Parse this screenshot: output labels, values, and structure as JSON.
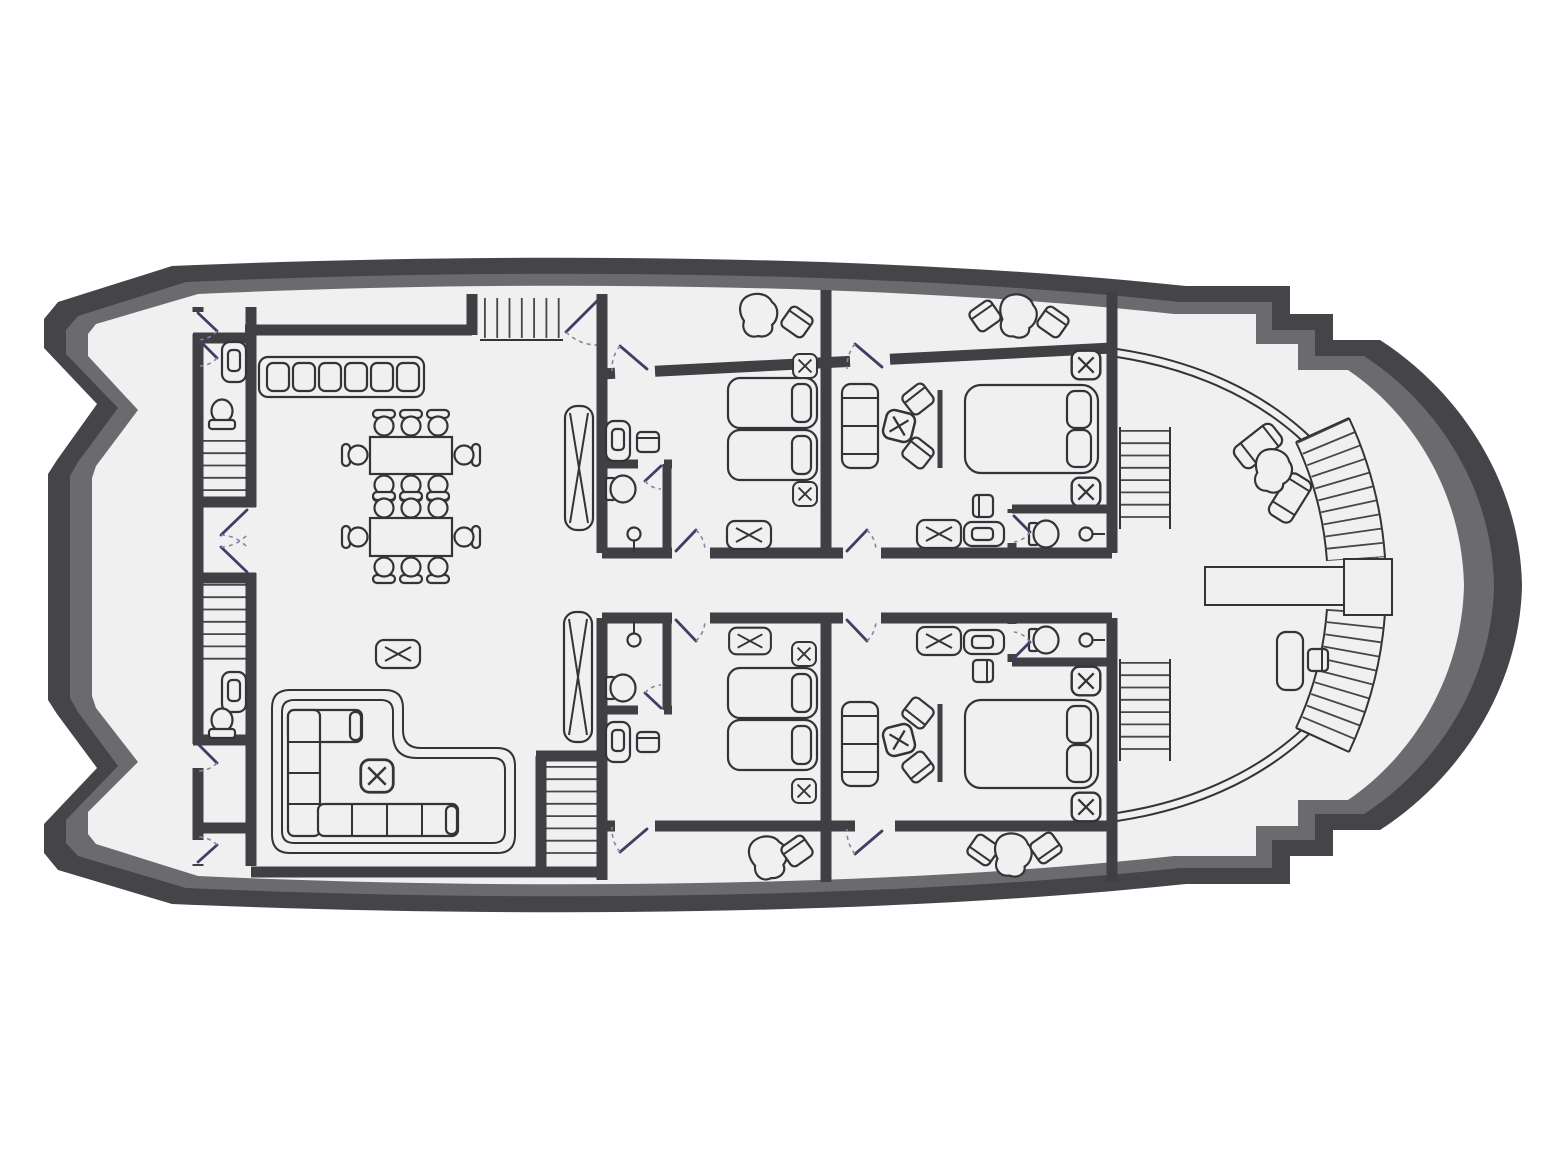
{
  "meta": {
    "label": "Motor yacht main-deck floor plan, top view, no text labels",
    "diagram_type": "floor-plan"
  },
  "colors": {
    "page": "#ffffff",
    "hull_dark": "#454549",
    "hull_mid": "#6b6b6f",
    "floor": "#f0f0f1",
    "wall": "#3f3f44",
    "line": "#333338",
    "door": "#3f3f66",
    "door_arc": "#8585a5"
  },
  "regions": [
    {
      "id": "aft-deck",
      "icon": "open-deck"
    },
    {
      "id": "service-column-port",
      "icon": "stairs-and-wc"
    },
    {
      "id": "wc-forward",
      "icon": "toilet-sink"
    },
    {
      "id": "wc-aft",
      "icon": "toilet-sink"
    },
    {
      "id": "salon-dining",
      "icon": "dining-tables"
    },
    {
      "id": "galley-counter",
      "icon": "cabinet-row",
      "units": 6
    },
    {
      "id": "lounge-pit",
      "icon": "l-shaped-sofa"
    },
    {
      "id": "alcove-stairs-top",
      "icon": "staircase"
    },
    {
      "id": "stairs-bottom-mid",
      "icon": "staircase"
    },
    {
      "id": "dumbwaiter-shafts",
      "icon": "x-shaft",
      "units": 2
    },
    {
      "id": "guest-cabin-twin-top",
      "icon": "twin-bed-cabin"
    },
    {
      "id": "vip-cabin-top",
      "icon": "double-bed-suite"
    },
    {
      "id": "guest-cabin-twin-bottom",
      "icon": "twin-bed-cabin"
    },
    {
      "id": "vip-cabin-bottom",
      "icon": "double-bed-suite"
    },
    {
      "id": "cabin-balconies",
      "icon": "terrace",
      "units": 4
    },
    {
      "id": "corridor-mid",
      "icon": "hallway"
    },
    {
      "id": "bow-deck",
      "icon": "open-deck"
    },
    {
      "id": "bow-curved-staircase",
      "icon": "curved-stairs"
    },
    {
      "id": "bow-walkway-landing",
      "icon": "gangway"
    },
    {
      "id": "side-deck-steps",
      "icon": "stairs",
      "units": 2
    }
  ],
  "furniture_counts": {
    "dining_tables": 2,
    "dining_chairs": 16,
    "galley_cabinet_units": 6,
    "twin_beds": 4,
    "double_beds": 2,
    "sofas": 3,
    "coffee_tables_x": 4,
    "nightstands_x": 8,
    "luggage_racks_x": 4,
    "toilets": 6,
    "sinks": 6,
    "showers": 4,
    "sun_loungers": 2,
    "balcony_chairs": 6,
    "balcony_tables": 4,
    "desk": 1
  }
}
